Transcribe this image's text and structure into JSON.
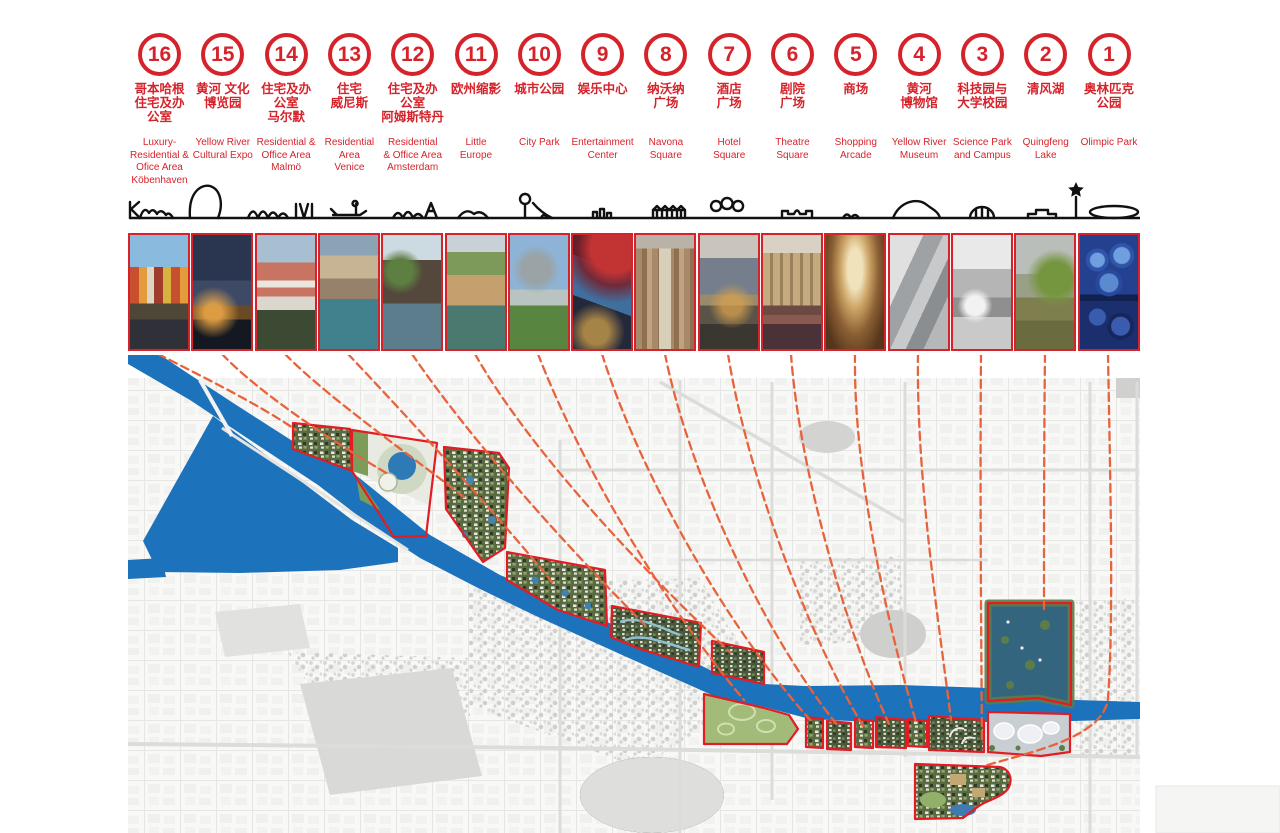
{
  "board_title": "Masterplan key map with referenced precedent sites",
  "colors": {
    "accent_red": "#d6232b",
    "parcel_outline_red": "#e31c23",
    "leader_orange": "#e8633c",
    "water_blue": "#1c73bc",
    "lake_teal": "#34657e",
    "fabric_gray": "#f0f0ef",
    "skyline_black": "#111111"
  },
  "icons": {
    "star": "star-icon",
    "skyline": "city-skyline-outline"
  },
  "sites": [
    {
      "num": "16",
      "cn": "哥本哈根\n住宅及办\n公室",
      "en": "Luxury-\nResidential &\nOfice Area\nKöbenhaven",
      "photo": "copenhagen-nyhavn-photo"
    },
    {
      "num": "15",
      "cn": "黄河 文化\n博览园",
      "en": "Yellow River\nCultural Expo",
      "photo": "night-skyline-expo-photo"
    },
    {
      "num": "14",
      "cn": "住宅及办\n公室\n马尔默",
      "en": "Residential &\nOffice Area\nMalmö",
      "photo": "malmo-waterfront-photo"
    },
    {
      "num": "13",
      "cn": "住宅\n威尼斯",
      "en": "Residential\nArea\nVenice",
      "photo": "venice-canal-photo"
    },
    {
      "num": "12",
      "cn": "住宅及办\n公室\n阿姆斯特丹",
      "en": "Residential\n& Office Area\nAmsterdam",
      "photo": "amsterdam-canal-houses-photo"
    },
    {
      "num": "11",
      "cn": "欧州缩影",
      "en": "Little\nEurope",
      "photo": "little-europe-village-photo"
    },
    {
      "num": "10",
      "cn": "城市公园",
      "en": "City Park",
      "photo": "city-park-cathedral-photo"
    },
    {
      "num": "9",
      "cn": "娱乐中心",
      "en": "Entertainment\nCenter",
      "photo": "entertainment-center-canopy-photo"
    },
    {
      "num": "8",
      "cn": "纳沃纳\n广场",
      "en": "Navona\nSquare",
      "photo": "navona-square-market-photo"
    },
    {
      "num": "7",
      "cn": "酒店\n广场",
      "en": "Hotel\nSquare",
      "photo": "hotel-square-dusk-photo"
    },
    {
      "num": "6",
      "cn": "剧院\n广场",
      "en": "Theatre\nSquare",
      "photo": "theatre-square-crowd-photo"
    },
    {
      "num": "5",
      "cn": "商场",
      "en": "Shopping\nArcade",
      "photo": "shopping-arcade-galleria-photo"
    },
    {
      "num": "4",
      "cn": "黄河\n博物馆",
      "en": "Yellow River\nMuseum",
      "photo": "museum-modern-concrete-photo"
    },
    {
      "num": "3",
      "cn": "科技园与\n大学校园",
      "en": "Science Park\nand Campus",
      "photo": "campus-rotunda-photo"
    },
    {
      "num": "2",
      "cn": "清风湖",
      "en": "Quingfeng\nLake",
      "photo": "qingfeng-lake-trees-photo"
    },
    {
      "num": "1",
      "cn": "奥林匹克\n公园",
      "en": "Olimpic Park",
      "photo": "water-cube-photo"
    }
  ]
}
